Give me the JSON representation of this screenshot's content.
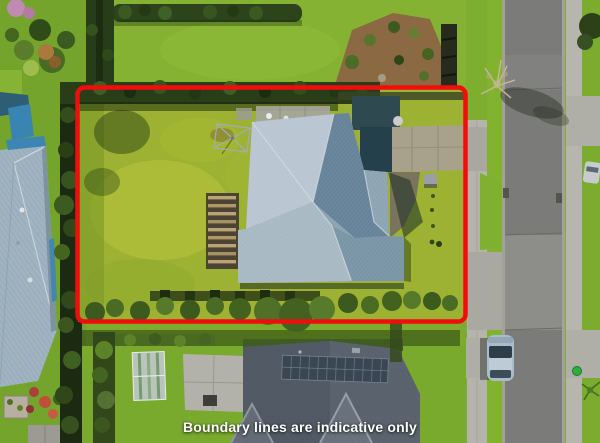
{
  "overlay": {
    "caption": "Boundary lines are indicative only",
    "boundary_color": "#f20d0d"
  },
  "scene": {
    "description": "Aerial drone photograph of a residential section: blue-grey hip-roofed house with large lawn outlined by a red boundary rectangle, neighbouring houses left and below, street with parked car on the right"
  }
}
